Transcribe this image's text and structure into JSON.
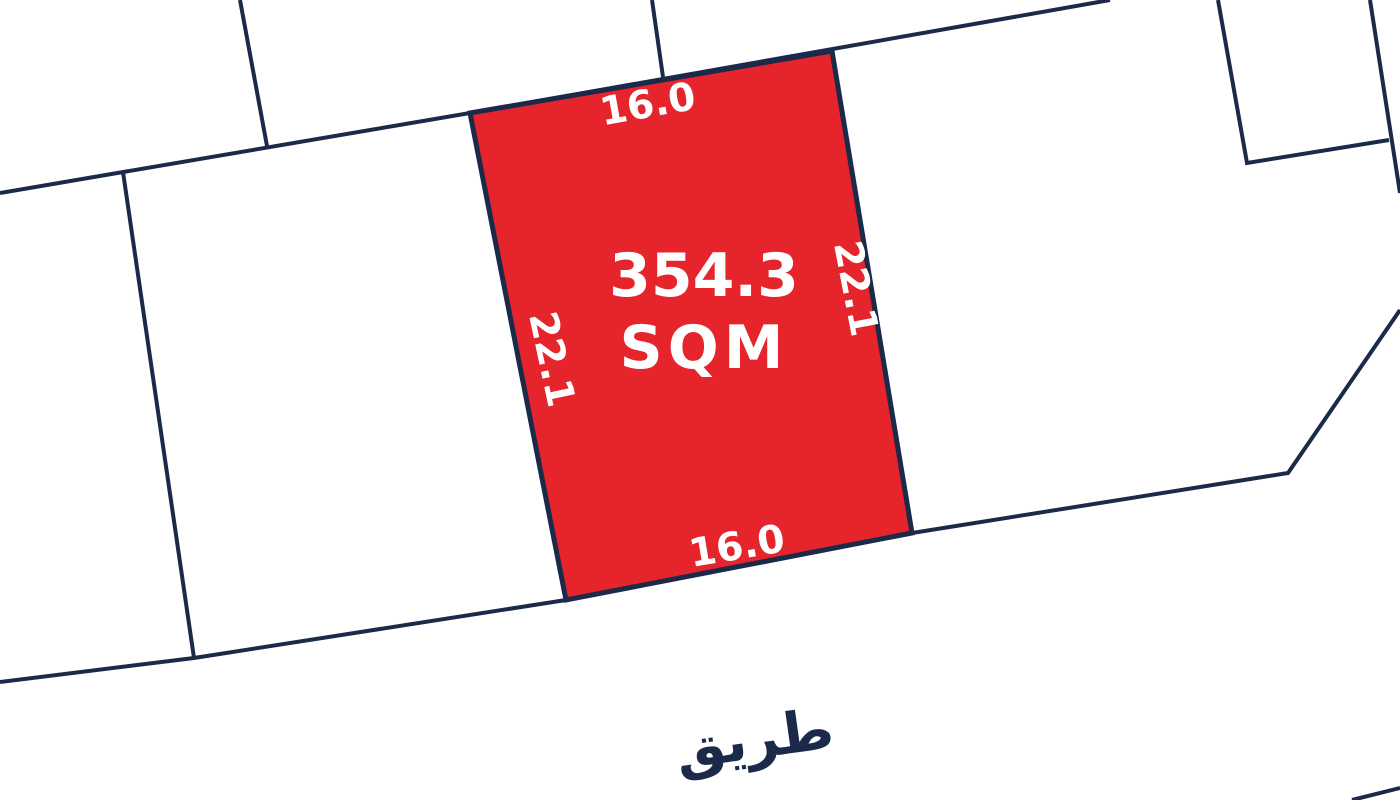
{
  "map": {
    "highlighted_plot": {
      "area_value": "354.3",
      "area_unit": "SQM",
      "dimensions": {
        "top": "16.0",
        "bottom": "16.0",
        "left": "22.1",
        "right": "22.1"
      }
    },
    "road_label": "طريق",
    "colors": {
      "plot_fill": "#e5242c",
      "boundary_line": "#1b2a4a",
      "plot_label_text": "#ffffff",
      "road_label_text": "#1b2a4a",
      "background": "#ffffff"
    }
  }
}
